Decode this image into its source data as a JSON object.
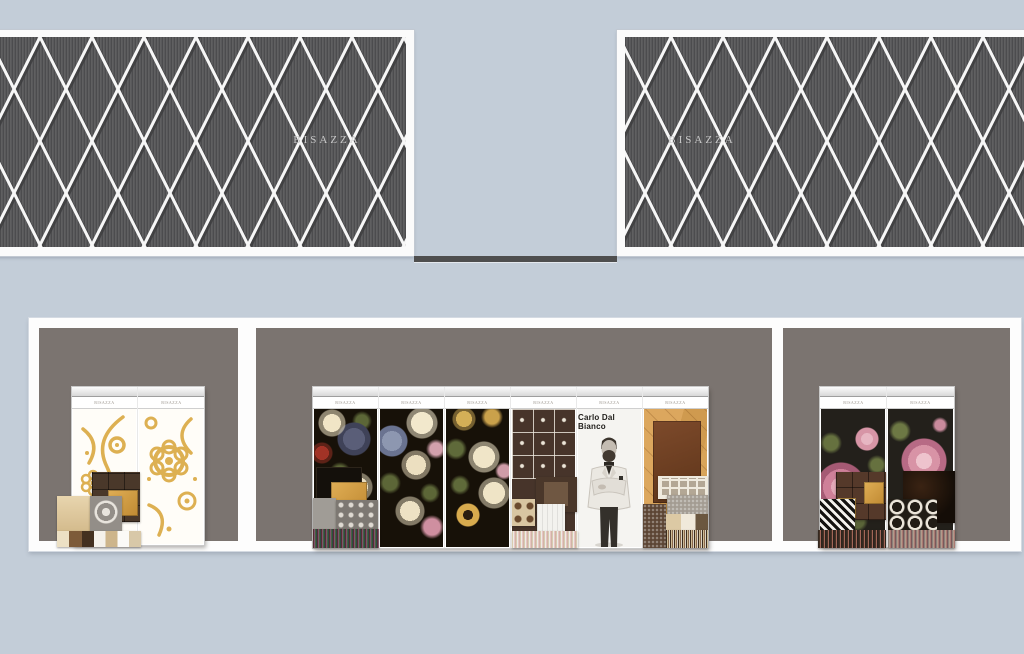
{
  "title": "Bisazza showroom elevation renderings",
  "brand": {
    "label": "BISAZZA"
  },
  "facade": {
    "left": {
      "sign": "BISAZZA"
    },
    "right": {
      "sign": "BISAZZA"
    },
    "pattern": "white diamond lattice over dark pinstriped panel",
    "field_color": "#59595b",
    "lattice_color": "#f7f7f7"
  },
  "showroom": {
    "left_bay": {
      "panels": [
        {
          "label": "BISAZZA",
          "art": "gold ornament mosaic on white"
        },
        {
          "label": "BISAZZA",
          "art": "gold ornament mosaic on white, large rosette"
        }
      ],
      "samples": [
        "brown tile grid with gold inset",
        "beige tile",
        "gray damask tile",
        "striped sample row"
      ]
    },
    "center_bay": {
      "panels": [
        {
          "label": "BISAZZA",
          "art": "dark baroque floral mosaic"
        },
        {
          "label": "BISAZZA",
          "art": "dark baroque floral mosaic"
        },
        {
          "label": "BISAZZA",
          "art": "dark baroque floral mosaic with sunflower"
        },
        {
          "label": "BISAZZA",
          "art": "white ornament grid on brown"
        },
        {
          "label": "BISAZZA",
          "art": "designer portrait",
          "name": "Carlo Dal Bianco"
        },
        {
          "label": "BISAZZA",
          "art": "wood parquet with leather panel and greek-key mosaic"
        }
      ],
      "samples": [
        "black tile with gold square",
        "dotted gray tiles",
        "striped sample rows",
        "greek-key mosaic",
        "mosaic bust sample"
      ]
    },
    "right_bay": {
      "panels": [
        {
          "label": "BISAZZA",
          "art": "pink roses on black mosaic"
        },
        {
          "label": "BISAZZA",
          "art": "large pink rose on black mosaic"
        }
      ],
      "samples": [
        "brown tile grid with gold insets",
        "houndstooth mosaic",
        "glossy dark tile",
        "hexagon mosaic",
        "striped sample rows"
      ]
    }
  },
  "palette": {
    "background": "#c3cdd8",
    "facade_field": "#59595b",
    "lattice": "#f7f7f7",
    "connector_bar": "#4e4e4e",
    "wall": "#fdfdfd",
    "bay_interior": "#7b7470",
    "gold": "#ddb052"
  }
}
